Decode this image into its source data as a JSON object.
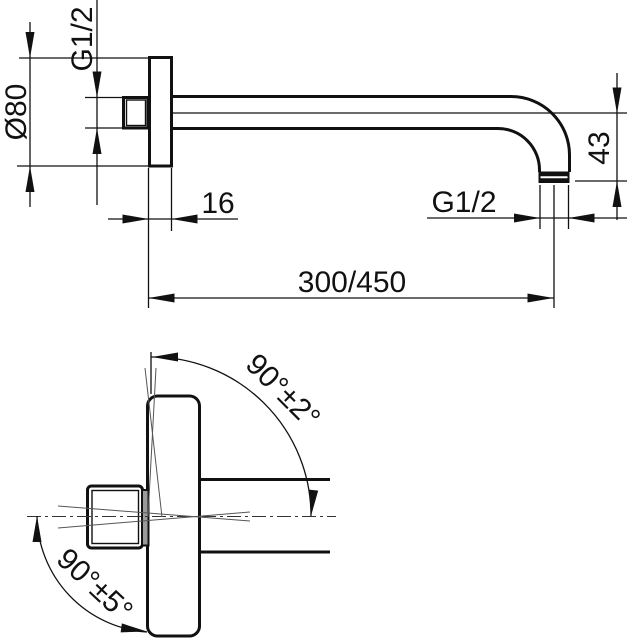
{
  "drawing": {
    "type": "technical-dimension-drawing",
    "subject": "wall-mounted shower arm with round flange, two views",
    "background": "#ffffff",
    "line_color": "#111111"
  },
  "dims": {
    "flange_diameter": "Ø80",
    "wall_thread": "G1/2",
    "flange_depth": "16",
    "arm_length": "300/450",
    "outlet_thread": "G1/2",
    "outlet_drop": "43",
    "front_angle": "90°±2°",
    "plan_angle": "90°±5°"
  }
}
